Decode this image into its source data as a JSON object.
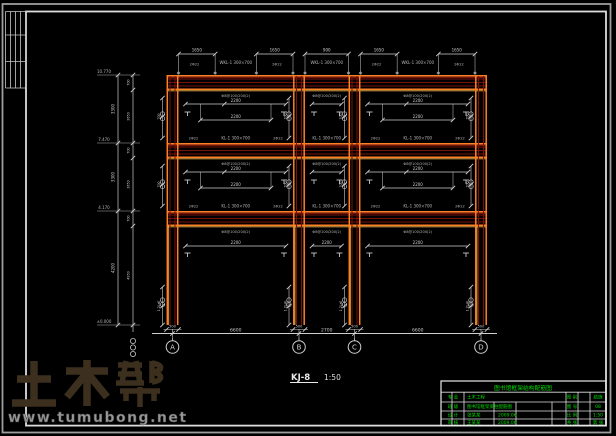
{
  "colors": {
    "background": "#000000",
    "beam_orange": "#ff8126",
    "beam_highlight": "#ffc04d",
    "beam_dark_red": "#7a1208",
    "beam_red": "#b22015",
    "annotation_gray": "#b5b5b5",
    "dim_gray": "#cfcfcf",
    "border_gray": "#9e9e9e",
    "inner_border_gray": "#dcdcdc",
    "title_green": "#00dd00",
    "watermark_brown": "#3c2f1e",
    "watermark_url_gray": "#989898",
    "label_white": "#e8e8e8"
  },
  "watermark": {
    "brand": "土木帮",
    "url": "www.tumubong.net"
  },
  "drawing_label": {
    "name": "KJ-8",
    "scale": "1:50"
  },
  "frame": {
    "left": 166.5,
    "right": 487,
    "column_width": 12,
    "columns": [
      {
        "axis": "A",
        "cx": 172.5
      },
      {
        "axis": "B",
        "cx": 299
      },
      {
        "axis": "C",
        "cx": 354.5
      },
      {
        "axis": "D",
        "cx": 481
      }
    ],
    "bands": [
      {
        "y": 75
      },
      {
        "y": 143
      },
      {
        "y": 211
      }
    ],
    "band_height": 15,
    "column_top": 75,
    "column_bottom": 325,
    "ground_y": 333.5,
    "span_labels": [
      "6600",
      "2700",
      "6600"
    ],
    "column_base_dim": "500"
  },
  "left_dims": {
    "chain1_x": 118,
    "chain2_x": 133,
    "top_y": 75,
    "bottom_y": 325,
    "elevation_top": "10.770",
    "elevations": [
      "7.470",
      "4.170",
      "±0.000"
    ],
    "story_dims": [
      "3300",
      "3300",
      "4200"
    ],
    "sub_dims": [
      "700",
      "2650",
      "700",
      "2650",
      "700",
      "4950"
    ]
  },
  "annotations": {
    "roof_beam_label": "WKL-1 300×700",
    "beam_label": "KL-1 300×700",
    "stirrup": "Φ8@100/200(2)",
    "top_bar": "2Φ22",
    "panel_dim": "2200",
    "top_cut_dims": [
      "1650",
      "900",
      "1650"
    ],
    "side_dim": "700",
    "lap_dim": "1.2LaE"
  },
  "title_block": {
    "title": "图书馆框架结构配筋图",
    "rows": [
      {
        "a": "专 业",
        "b": "土木工程",
        "c": "",
        "d": "图 别",
        "e": "结施"
      },
      {
        "a": "班 级",
        "b": "图书馆框架梁柱配筋图",
        "c": "",
        "d": "图 号",
        "e": "08"
      },
      {
        "a": "设 计",
        "b": "张某某",
        "c": "2009.06",
        "d": "比 例",
        "e": "1:50"
      },
      {
        "a": "审 核",
        "b": "王某某",
        "c": "2009.06",
        "d": "共 张",
        "e": "第 张"
      }
    ]
  }
}
